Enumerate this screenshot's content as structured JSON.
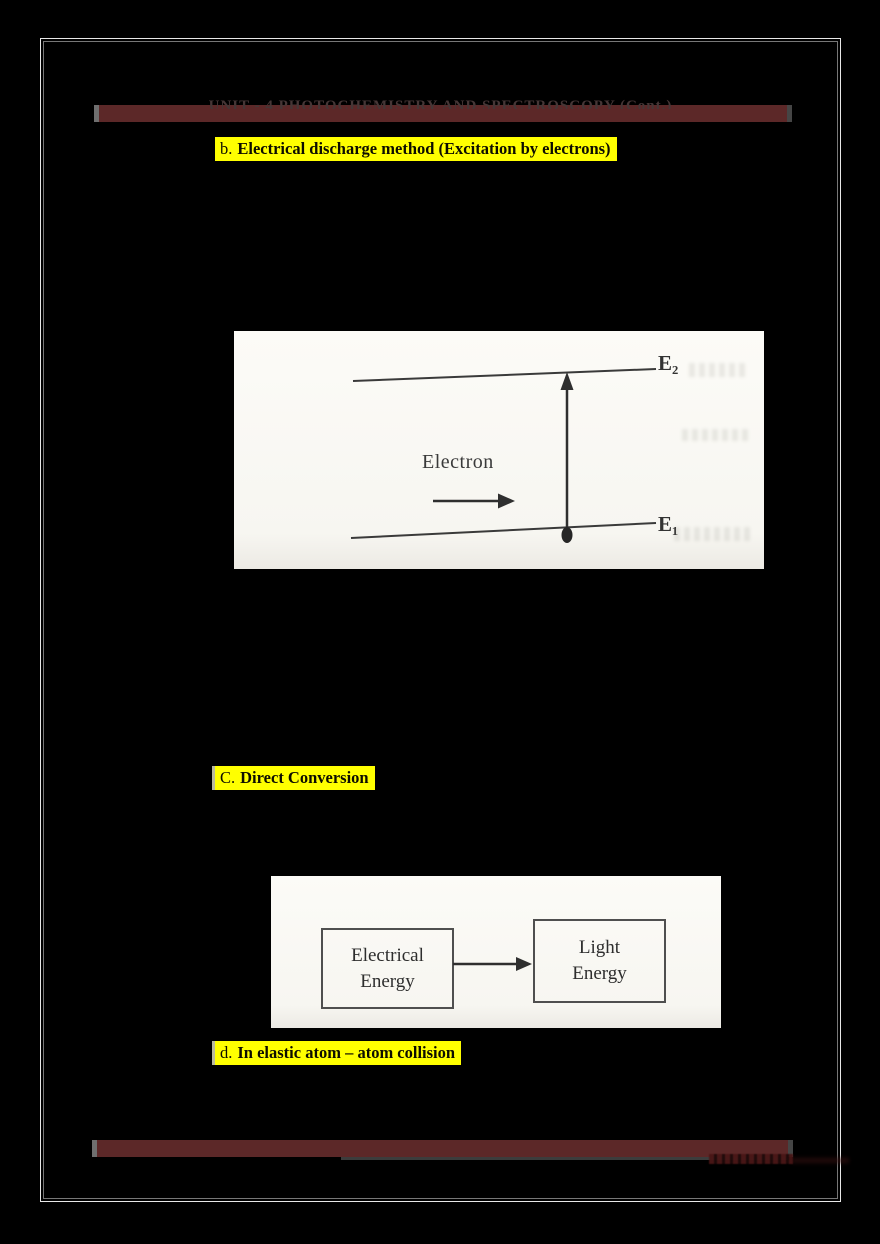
{
  "header": {
    "clipped_title": "UNIT - 4 PHOTOCHEMISTRY AND SPECTROSCOPY (Cont.)"
  },
  "sections": {
    "b": {
      "prefix": "b.",
      "title": "Electrical discharge method (Excitation by electrons)"
    },
    "c": {
      "prefix": "C.",
      "title": "Direct Conversion"
    },
    "d": {
      "prefix": "d.",
      "title": "In elastic atom – atom collision"
    }
  },
  "figure_energy_levels": {
    "label_e2": "E₂",
    "label_e1": "E₁",
    "electron_label": "Electron"
  },
  "figure_direct_conversion": {
    "box_left_line1": "Electrical",
    "box_left_line2": "Energy",
    "box_right_line1": "Light",
    "box_right_line2": "Energy"
  },
  "colors": {
    "highlight_yellow": "#ffff00",
    "bar_maroon": "#5c2828",
    "page_background": "#000000",
    "panel_background": "#fbfaf5",
    "ink": "#333333",
    "frame_line": "#e8e8e8"
  }
}
